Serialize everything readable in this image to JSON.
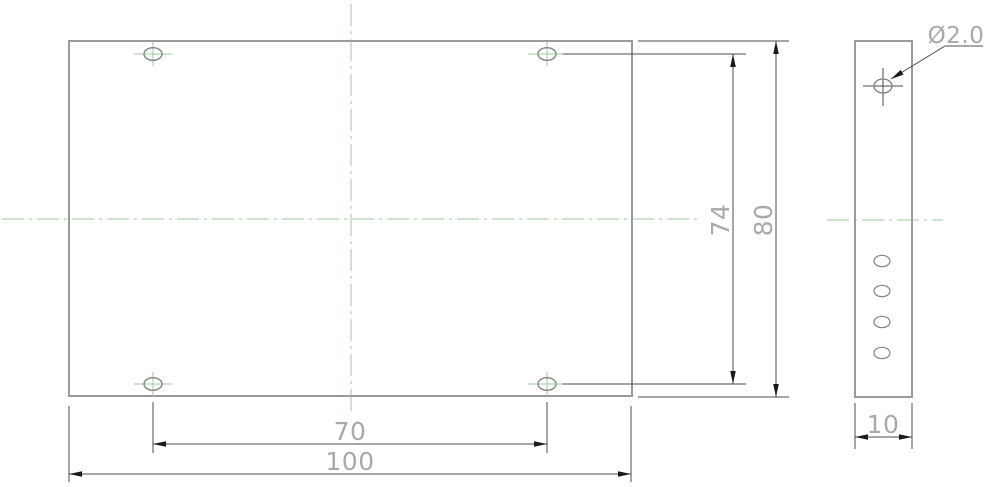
{
  "title": "plate-technical-drawing",
  "colors": {
    "background": "#ffffff",
    "outline": "#9a9a9a",
    "hole_outline": "#7c837c",
    "dimension_line": "#4d4d4d",
    "arrow": "#1a1a1a",
    "text": "#a9a9a9",
    "centerline": "#99cb99"
  },
  "views": {
    "front": {
      "name": "front-view",
      "outline": {
        "x": 69,
        "y": 41,
        "w": 563,
        "h": 355
      },
      "hole_rx": 9,
      "hole_ry": 6.3,
      "holes": [
        {
          "cx": 153,
          "cy": 54
        },
        {
          "cx": 547,
          "cy": 54
        },
        {
          "cx": 153,
          "cy": 384
        },
        {
          "cx": 547,
          "cy": 384
        }
      ]
    },
    "side": {
      "name": "side-view",
      "outline": {
        "x": 855,
        "y": 41,
        "w": 57,
        "h": 356
      },
      "top_hole": {
        "cx": 883,
        "cy": 86,
        "rx": 9,
        "ry": 7
      },
      "slot_rx": 8,
      "slot_ry": 5.7,
      "slot_holes": [
        {
          "cx": 882,
          "cy": 261
        },
        {
          "cx": 882,
          "cy": 291
        },
        {
          "cx": 882,
          "cy": 322
        },
        {
          "cx": 882,
          "cy": 353
        }
      ]
    }
  },
  "centerlines": [
    {
      "name": "front-horizontal-centerline",
      "x1": 2,
      "y1": 219,
      "x2": 700,
      "y2": 219
    },
    {
      "name": "front-vertical-centerline",
      "x1": 351,
      "y1": 4,
      "x2": 351,
      "y2": 416
    },
    {
      "name": "side-horizontal-centerline",
      "x1": 827,
      "y1": 220,
      "x2": 943,
      "y2": 220
    }
  ],
  "dimensions": [
    {
      "name": "dim-hole-spacing-horizontal",
      "label": "70",
      "line": {
        "x1": 153,
        "y1": 444,
        "x2": 547,
        "y2": 444
      },
      "ext": [
        {
          "x1": 153,
          "y1": 402,
          "x2": 153,
          "y2": 453
        },
        {
          "x1": 547,
          "y1": 402,
          "x2": 547,
          "y2": 453
        }
      ],
      "arrows": [
        {
          "x": 153,
          "y": 444,
          "angle": 180
        },
        {
          "x": 547,
          "y": 444,
          "angle": 0
        }
      ],
      "text": {
        "x": 350,
        "y": 440,
        "rotate": false
      }
    },
    {
      "name": "dim-plate-width",
      "label": "100",
      "line": {
        "x1": 69,
        "y1": 474,
        "x2": 631,
        "y2": 474
      },
      "ext": [
        {
          "x1": 69,
          "y1": 406,
          "x2": 69,
          "y2": 482
        },
        {
          "x1": 631,
          "y1": 406,
          "x2": 631,
          "y2": 482
        }
      ],
      "arrows": [
        {
          "x": 69,
          "y": 474,
          "angle": 180
        },
        {
          "x": 631,
          "y": 474,
          "angle": 0
        }
      ],
      "text": {
        "x": 350,
        "y": 470,
        "rotate": false
      }
    },
    {
      "name": "dim-hole-spacing-vertical",
      "label": "74",
      "line": {
        "x1": 733,
        "y1": 54,
        "x2": 733,
        "y2": 384
      },
      "ext": [
        {
          "x1": 563,
          "y1": 54,
          "x2": 746,
          "y2": 54
        },
        {
          "x1": 563,
          "y1": 384,
          "x2": 746,
          "y2": 384
        }
      ],
      "arrows": [
        {
          "x": 733,
          "y": 54,
          "angle": -90
        },
        {
          "x": 733,
          "y": 384,
          "angle": 90
        }
      ],
      "text": {
        "x": 729,
        "y": 220,
        "rotate": true
      }
    },
    {
      "name": "dim-plate-height",
      "label": "80",
      "line": {
        "x1": 776,
        "y1": 41,
        "x2": 776,
        "y2": 397
      },
      "ext": [
        {
          "x1": 638,
          "y1": 41,
          "x2": 789,
          "y2": 41
        },
        {
          "x1": 638,
          "y1": 397,
          "x2": 789,
          "y2": 397
        }
      ],
      "arrows": [
        {
          "x": 776,
          "y": 41,
          "angle": -90
        },
        {
          "x": 776,
          "y": 397,
          "angle": 90
        }
      ],
      "text": {
        "x": 772,
        "y": 220,
        "rotate": true
      }
    },
    {
      "name": "dim-plate-thickness",
      "label": "10",
      "line": {
        "x1": 855,
        "y1": 437,
        "x2": 912,
        "y2": 437
      },
      "ext": [
        {
          "x1": 855,
          "y1": 403,
          "x2": 855,
          "y2": 449
        },
        {
          "x1": 912,
          "y1": 403,
          "x2": 912,
          "y2": 449
        }
      ],
      "arrows": [
        {
          "x": 855,
          "y": 437,
          "angle": 180
        },
        {
          "x": 912,
          "y": 437,
          "angle": 0
        }
      ],
      "text": {
        "x": 883,
        "y": 433,
        "rotate": false
      }
    }
  ],
  "leader": {
    "name": "hole-diameter-callout",
    "label": "Ø2.0",
    "points": [
      [
        891,
        79
      ],
      [
        945,
        46
      ],
      [
        983,
        46
      ]
    ],
    "arrow": {
      "x": 891,
      "y": 79,
      "angle": 148.5
    },
    "text": {
      "x": 956,
      "y": 43
    }
  }
}
